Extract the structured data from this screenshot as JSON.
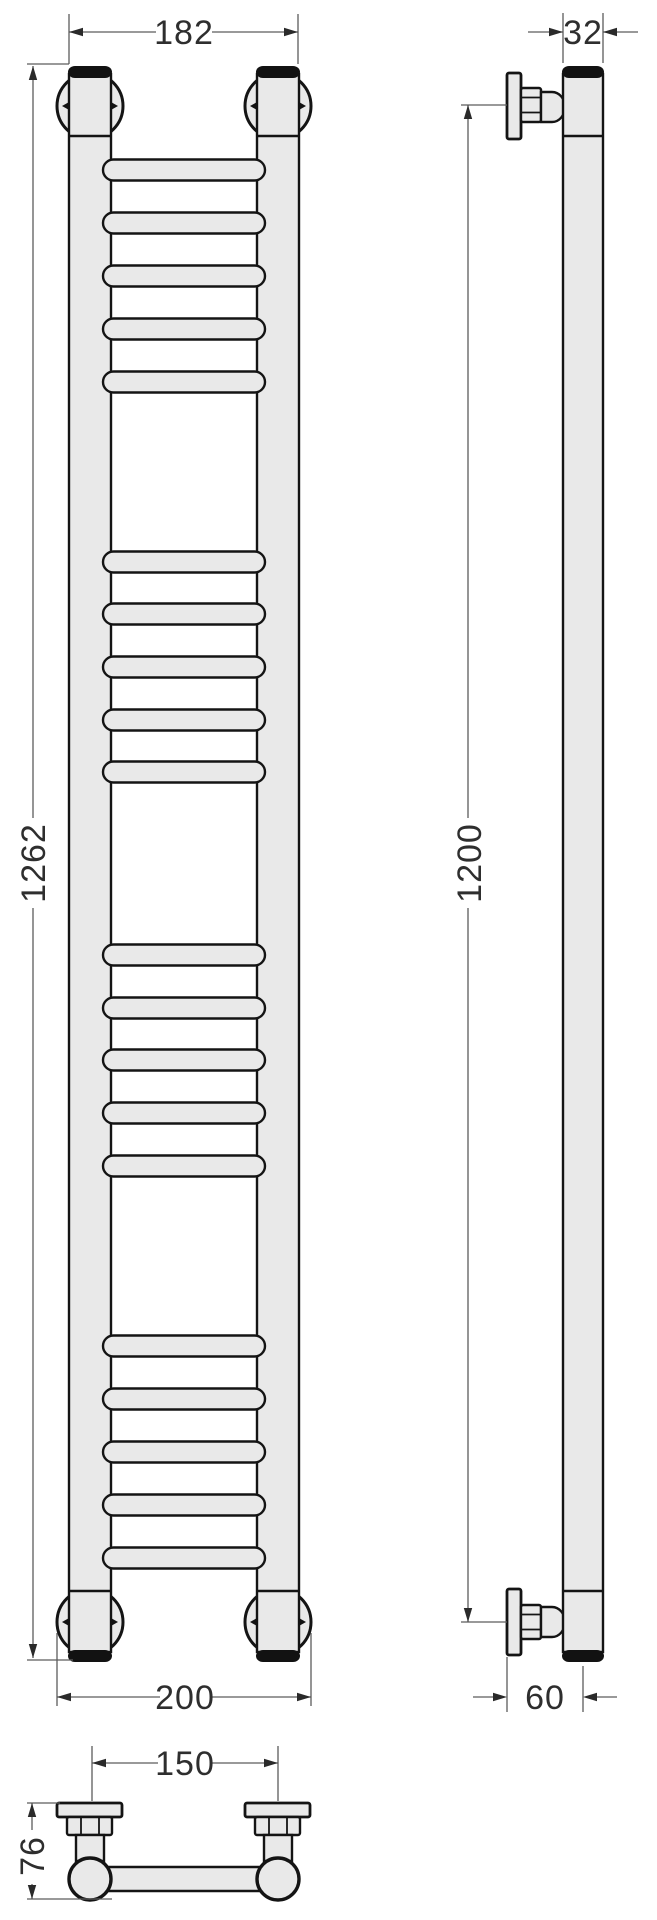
{
  "drawing": {
    "title": "ladder towel rail technical drawing",
    "view_names": [
      "front view",
      "side view",
      "plan view"
    ],
    "dimensions_mm": {
      "front_outer_width_top": "182",
      "front_overall_height": "1262",
      "front_outer_width_bottom": "200",
      "tube_diameter": "32",
      "mount_span_height": "1200",
      "wall_to_tube_axis": "60",
      "bracket_center_spacing": "150",
      "bracket_depth": "76"
    },
    "front_view": {
      "group_count": 4,
      "rungs_per_group": 5,
      "rung_centers_y": [
        170,
        223,
        276,
        329,
        382,
        562,
        614,
        667,
        720,
        772,
        955,
        1008,
        1060,
        1113,
        1166,
        1346,
        1399,
        1452,
        1505,
        1558
      ],
      "rung_x": 103,
      "rung_width": 162,
      "rung_height": 21
    },
    "colors": {
      "metal_fill": "#e9e9e9",
      "outline": "#141414",
      "dimension_lines": "#5c5c5c",
      "text": "#2e2e2e",
      "background": "#ffffff"
    }
  }
}
